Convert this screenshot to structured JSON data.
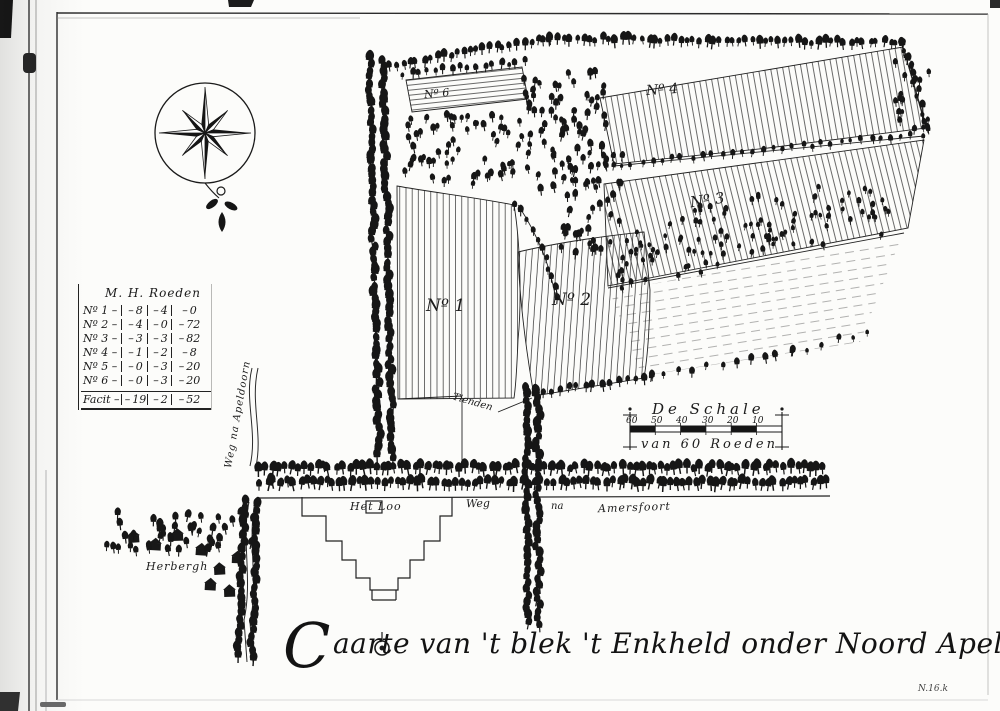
{
  "map": {
    "title": {
      "initial": "C",
      "rest": "aarte van 't blek 't Enkheld onder Noord Apeldoorn"
    },
    "corner_mark": "N.16.k",
    "plot_labels": [
      {
        "label": "Nº 1"
      },
      {
        "label": "Nº 2"
      },
      {
        "label": "Nº 3"
      },
      {
        "label": "Nº 4"
      },
      {
        "label": "Nº 6"
      }
    ],
    "road_labels": {
      "het_loo": "Het Loo",
      "weg": "Weg",
      "na": "na",
      "amersfoort": "Amersfoort",
      "weg_na_apeldoorn": "Weg na Apeldoorn",
      "herbergh": "Herbergh",
      "tienden": "Tienden"
    }
  },
  "legend_table": {
    "header": "M. H. Roeden",
    "rows": [
      [
        "Nº 1",
        "8",
        "4",
        "0"
      ],
      [
        "Nº 2",
        "4",
        "0",
        "72"
      ],
      [
        "Nº 3",
        "3",
        "3",
        "82"
      ],
      [
        "Nº 4",
        "1",
        "2",
        "8"
      ],
      [
        "Nº 5",
        "0",
        "3",
        "20"
      ],
      [
        "Nº 6",
        "0",
        "3",
        "20"
      ]
    ],
    "total": [
      "Facit",
      "19",
      "2",
      "52"
    ]
  },
  "scale_bar": {
    "title": "De Schale",
    "subtitle": "van 60 Roeden",
    "ticks": [
      "60",
      "50",
      "40",
      "30",
      "20",
      "10"
    ]
  },
  "colors": {
    "ink": "#1a1a1a",
    "paper": "#fcfcfa"
  }
}
